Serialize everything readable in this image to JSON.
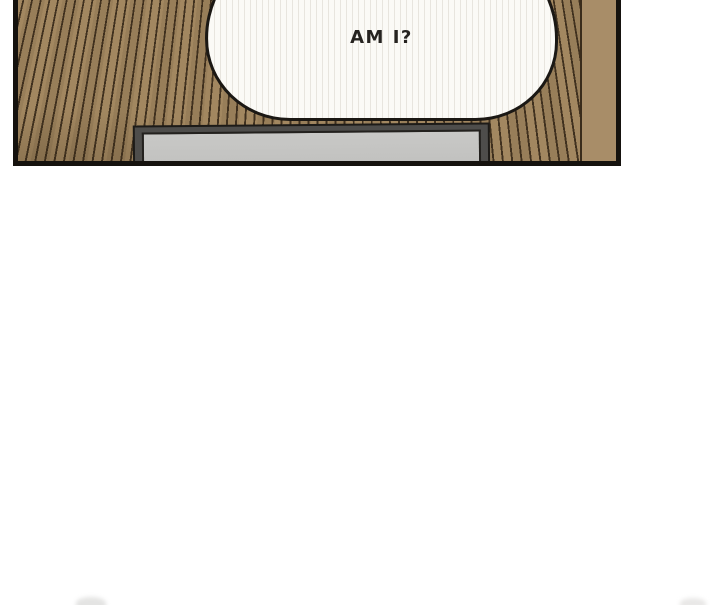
{
  "speech_bubble": {
    "text": "AM I?"
  },
  "colors": {
    "page-bg": "#ffffff",
    "panel-border": "#15120e",
    "wood-base": "#a28760",
    "wood-stripe": "#40311f",
    "wood-plain": "#a88d68",
    "bubble-fill": "#fbfaf6",
    "bubble-outline": "#1b1814",
    "frame-outline": "#1d1b18",
    "frame-outer": "#4e4d4b",
    "frame-glass": "#c2c2c0",
    "text-color": "#262320"
  }
}
